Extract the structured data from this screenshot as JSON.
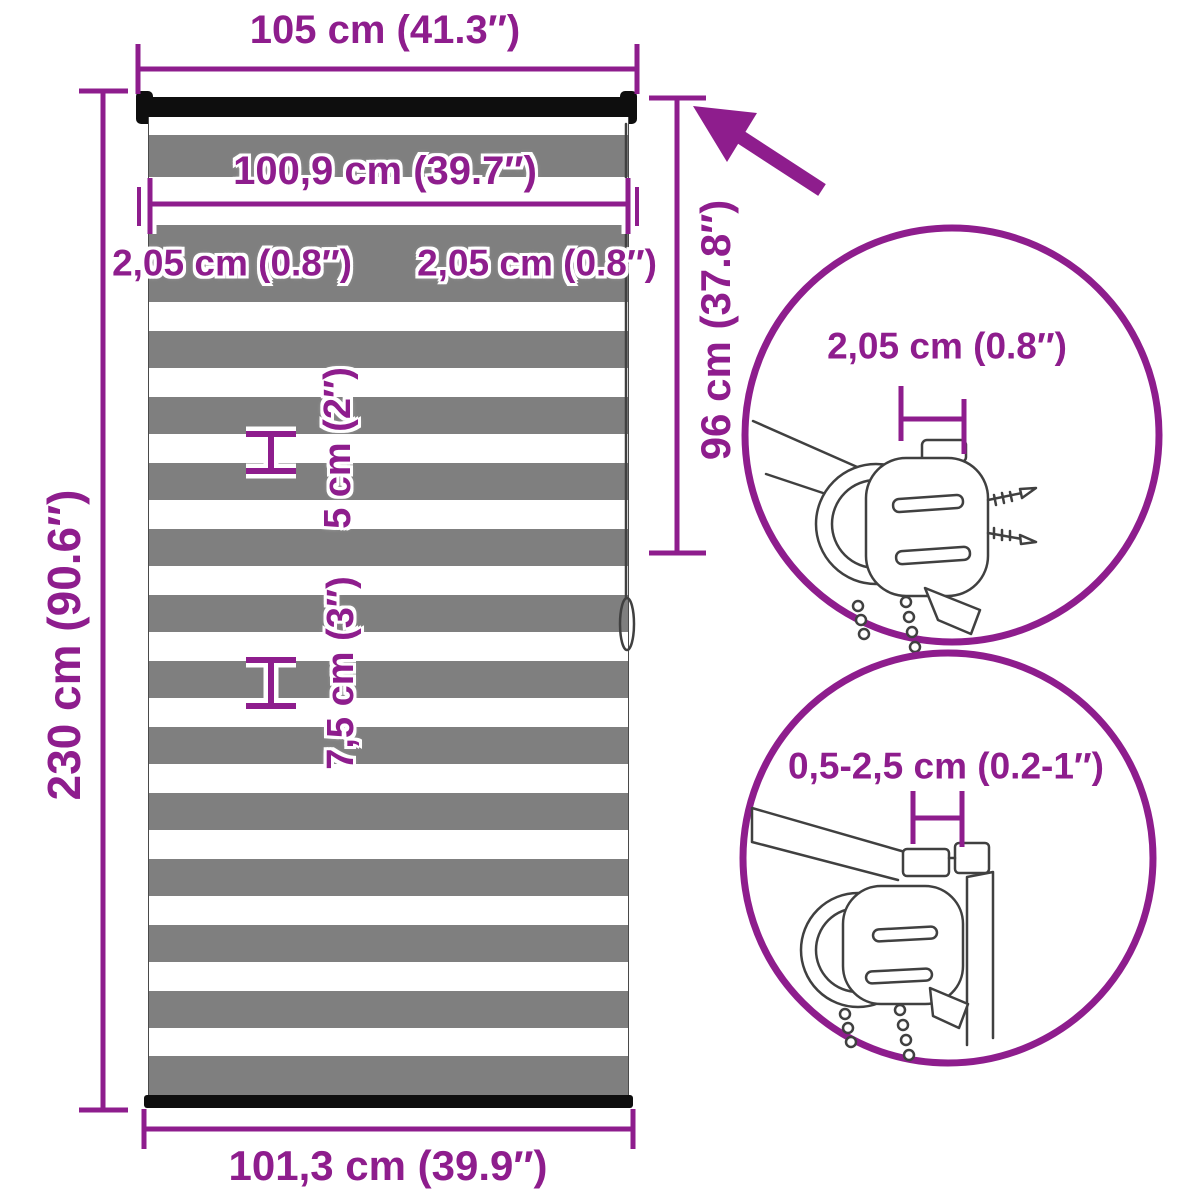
{
  "colors": {
    "accent": "#8e1d8d",
    "stripe_gray": "#7f7f7f",
    "rail_black": "#0e0e0e"
  },
  "dimensions": {
    "top_width": "105 cm (41.3″)",
    "fabric_width": "100,9 cm (39.7″)",
    "left_side_gap": "2,05 cm (0.8″)",
    "right_side_gap": "2,05 cm (0.8″)",
    "sheer_stripe_height": "5 cm (2″)",
    "fabric_stripe_height": "7,5 cm (3″)",
    "total_height": "230 cm (90.6″)",
    "drop_height": "96 cm (37.8″)",
    "bottom_width": "101,3 cm (39.9″)",
    "bracket_detail_width": "2,05 cm (0.8″)",
    "clamp_detail_range": "0,5-2,5 cm (0.2-1″)"
  }
}
